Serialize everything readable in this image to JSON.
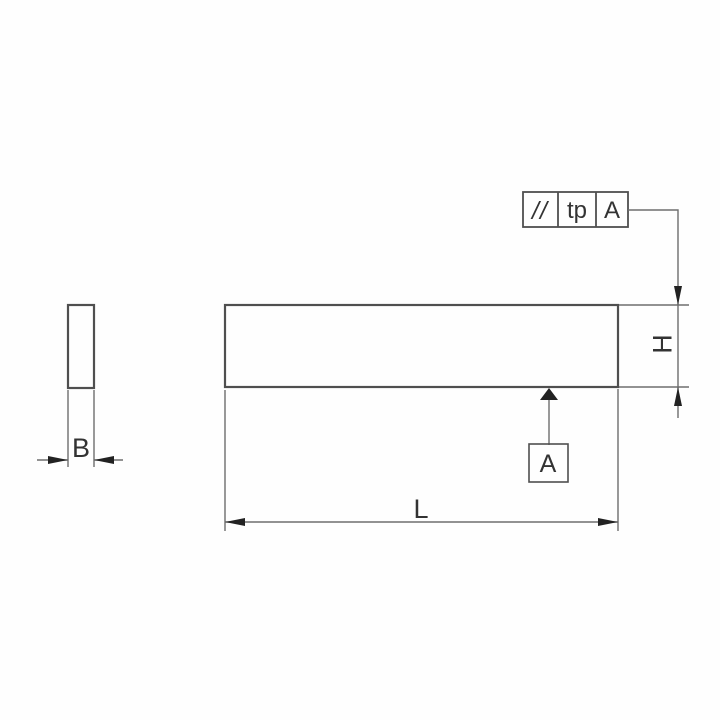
{
  "colors": {
    "background": "#fefefe",
    "outline": "#4f4f4f",
    "dimension_line": "#6e6e6e",
    "arrow": "#222222",
    "text": "#333333"
  },
  "tolerance_frame": {
    "parallelism_symbol": "//",
    "tolerance_value": "tp",
    "datum_reference": "A"
  },
  "datum": {
    "label": "A"
  },
  "dimensions": {
    "height_label": "H",
    "length_label": "L",
    "width_label": "B"
  }
}
